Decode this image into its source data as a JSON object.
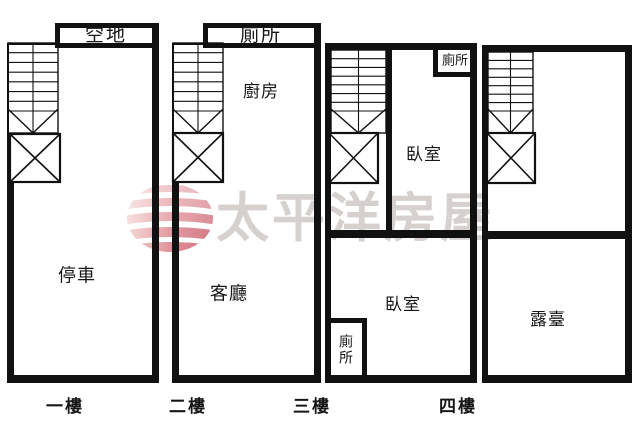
{
  "watermark": {
    "text": "太平洋房屋",
    "logo": "pacific-globe-icon",
    "text_color": "#d6d1ce",
    "logo_accent": "#bf3b4b"
  },
  "colors": {
    "wall": "#111111",
    "background": "#ffffff"
  },
  "floors": [
    {
      "name": "一樓",
      "rooms": [
        {
          "label": "空地"
        },
        {
          "label": "停車"
        }
      ]
    },
    {
      "name": "二樓",
      "rooms": [
        {
          "label": "廁所"
        },
        {
          "label": "廚房"
        },
        {
          "label": "客廳"
        }
      ]
    },
    {
      "name": "三樓",
      "rooms": [
        {
          "label": "廁所"
        },
        {
          "label": "臥室"
        },
        {
          "label": "臥室"
        },
        {
          "label": "廁所"
        }
      ]
    },
    {
      "name": "四樓",
      "rooms": [
        {
          "label": "露臺"
        }
      ]
    }
  ]
}
